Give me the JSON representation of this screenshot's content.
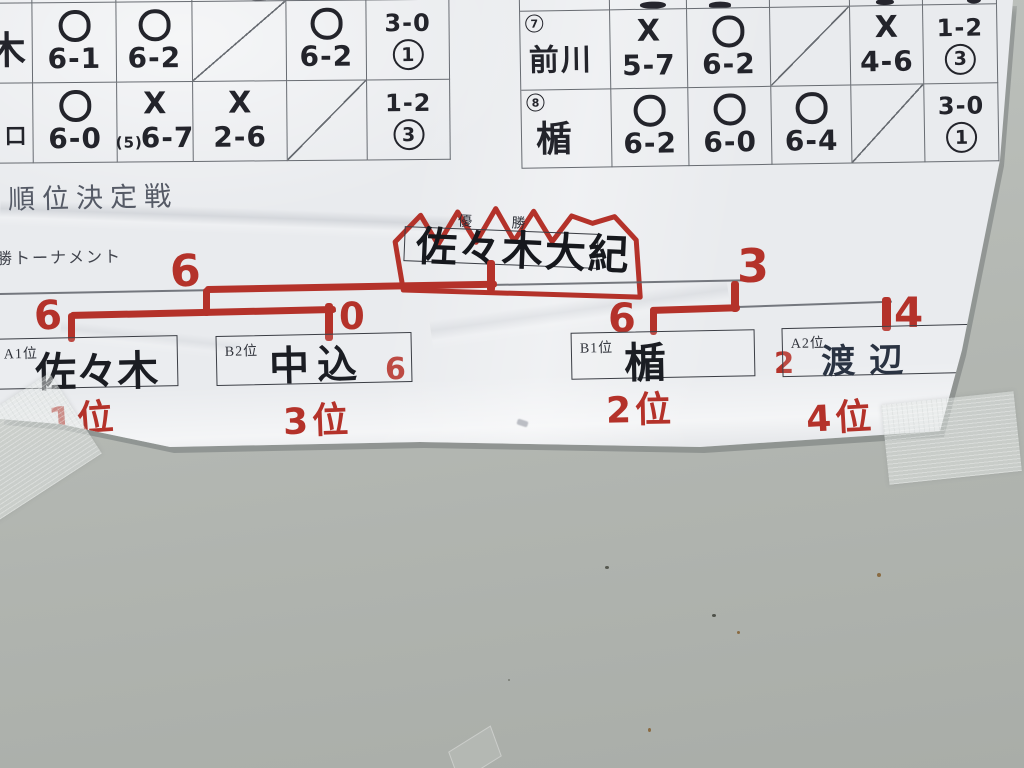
{
  "headings": {
    "section_title": "順位決定戦",
    "tournament_label": "勝トーナメント"
  },
  "left_table": {
    "rows": [
      {
        "name": "木",
        "cells": [
          {
            "mark": "〇",
            "score": "6-1"
          },
          {
            "mark": "〇",
            "score": "6-2"
          },
          {
            "self": true
          },
          {
            "mark": "〇",
            "score": "6-2"
          }
        ],
        "result": "3-0",
        "rank": "1"
      },
      {
        "name": "口",
        "cells": [
          {
            "mark": "〇",
            "score": "6-0"
          },
          {
            "mark": "✕",
            "tb": "(5)",
            "score": "6-7"
          },
          {
            "mark": "✕",
            "score": "2-6"
          },
          {
            "self": true
          }
        ],
        "result": "1-2",
        "rank": "3"
      }
    ]
  },
  "right_table": {
    "rows": [
      {
        "no": "7",
        "name": "前川",
        "cells": [
          {
            "mark": "✕",
            "score": "5-7"
          },
          {
            "mark": "〇",
            "score": "6-2"
          },
          {
            "self": true
          },
          {
            "mark": "✕",
            "score": "4-6"
          }
        ],
        "result": "1-2",
        "rank": "3"
      },
      {
        "no": "8",
        "name": "楯",
        "cells": [
          {
            "mark": "〇",
            "score": "6-2"
          },
          {
            "mark": "〇",
            "score": "6-0"
          },
          {
            "mark": "〇",
            "score": "6-4"
          },
          {
            "self": true
          }
        ],
        "result": "3-0",
        "rank": "1"
      }
    ]
  },
  "champion": {
    "title": "優 勝",
    "name": "佐々木大紀"
  },
  "bracket": {
    "final": {
      "left_score": "6",
      "right_score": "3"
    },
    "semi_left": {
      "left_score": "6",
      "right_score": "0"
    },
    "semi_right": {
      "left_score": "6",
      "right_score": "4"
    },
    "third_place": {
      "left_score": "6",
      "right_score": "2"
    },
    "players": [
      {
        "seed": "A1位",
        "name": "佐々木",
        "final_rank": "1位"
      },
      {
        "seed": "B2位",
        "name": "中込",
        "final_rank": "3位"
      },
      {
        "seed": "B1位",
        "name": "楯",
        "final_rank": "2位"
      },
      {
        "seed": "A2位",
        "name": "渡辺",
        "final_rank": "4位"
      }
    ]
  },
  "colors": {
    "marker_red": "#b4322a",
    "marker_black": "#23242b",
    "paper": "#e9ebee",
    "wall": "#b2b6b1",
    "table_line": "#686c72"
  }
}
